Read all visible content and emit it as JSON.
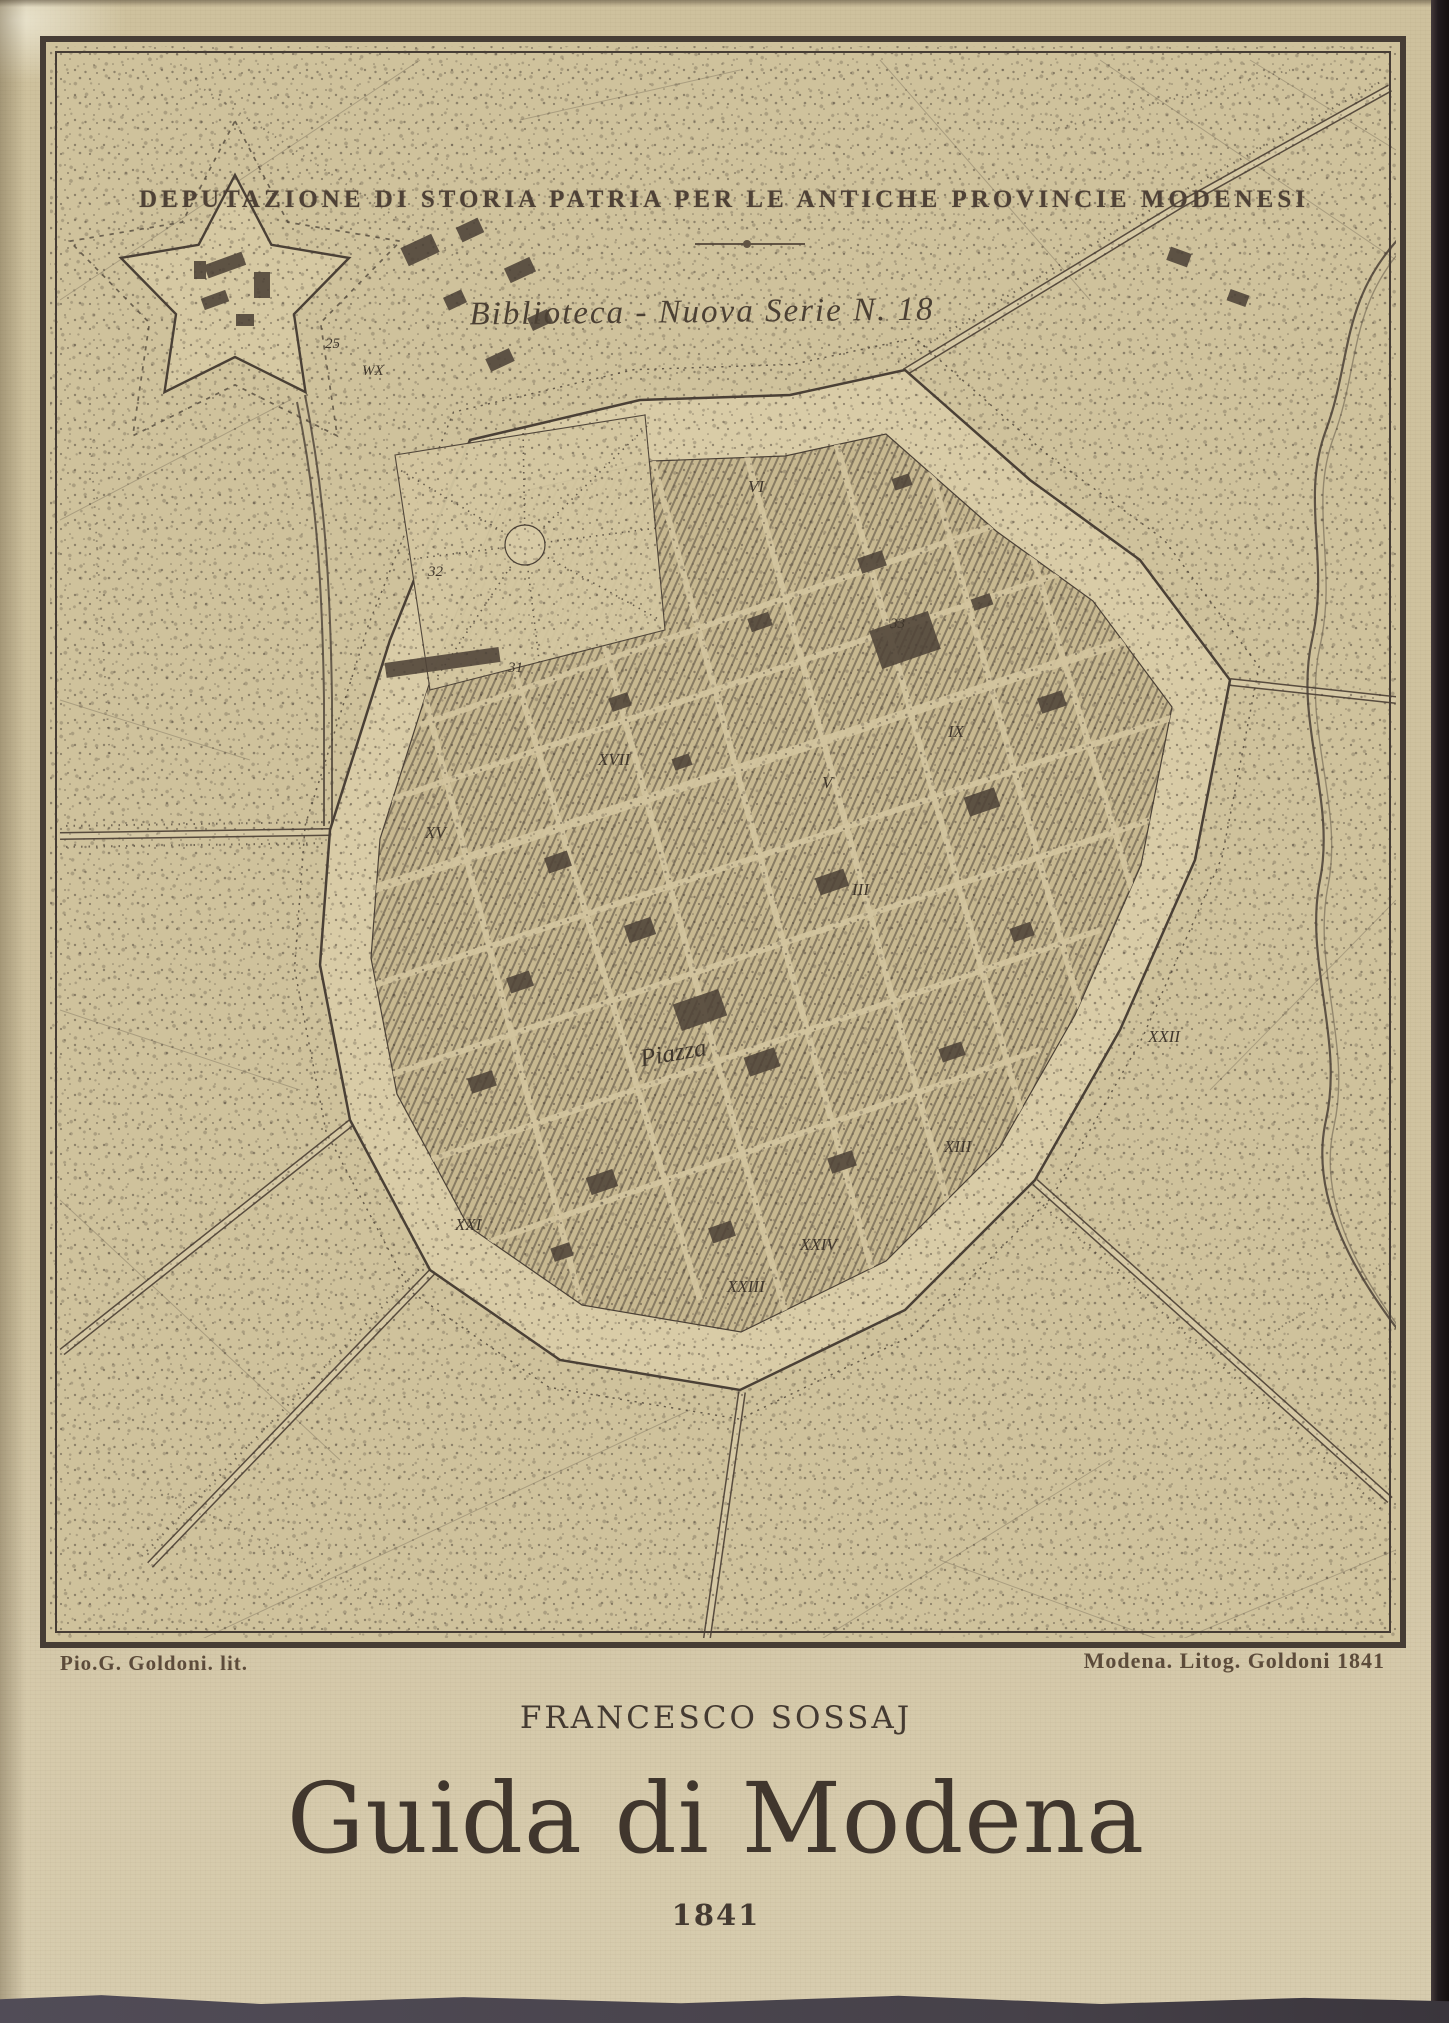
{
  "cover": {
    "institution": "DEPUTAZIONE DI STORIA PATRIA PER LE ANTICHE PROVINCIE MODENESI",
    "series": "Biblioteca - Nuova Serie N. 18",
    "author": "FRANCESCO SOSSAJ",
    "title": "Guida di Modena",
    "year": "1841"
  },
  "plate": {
    "credit_left": "Pio.G. Goldoni. lit.",
    "credit_right": "Modena.  Litog. Goldoni 1841",
    "place_label": "Piazza",
    "numerals": [
      "VI",
      "IX",
      "XVII",
      "XV",
      "V",
      "III",
      "XXII",
      "XIII",
      "XXI",
      "XXIV",
      "XXIII"
    ],
    "site_numbers": [
      "25",
      "WX",
      "32",
      "31",
      "33"
    ]
  },
  "colors": {
    "cover_paper": "#d0c3a0",
    "plate_paper": "#cfc29c",
    "ink": "#4a4036",
    "title_ink": "#40362e",
    "right_edge_dark": "#1d171a",
    "bottom_edge_dark": "#4c4752"
  }
}
